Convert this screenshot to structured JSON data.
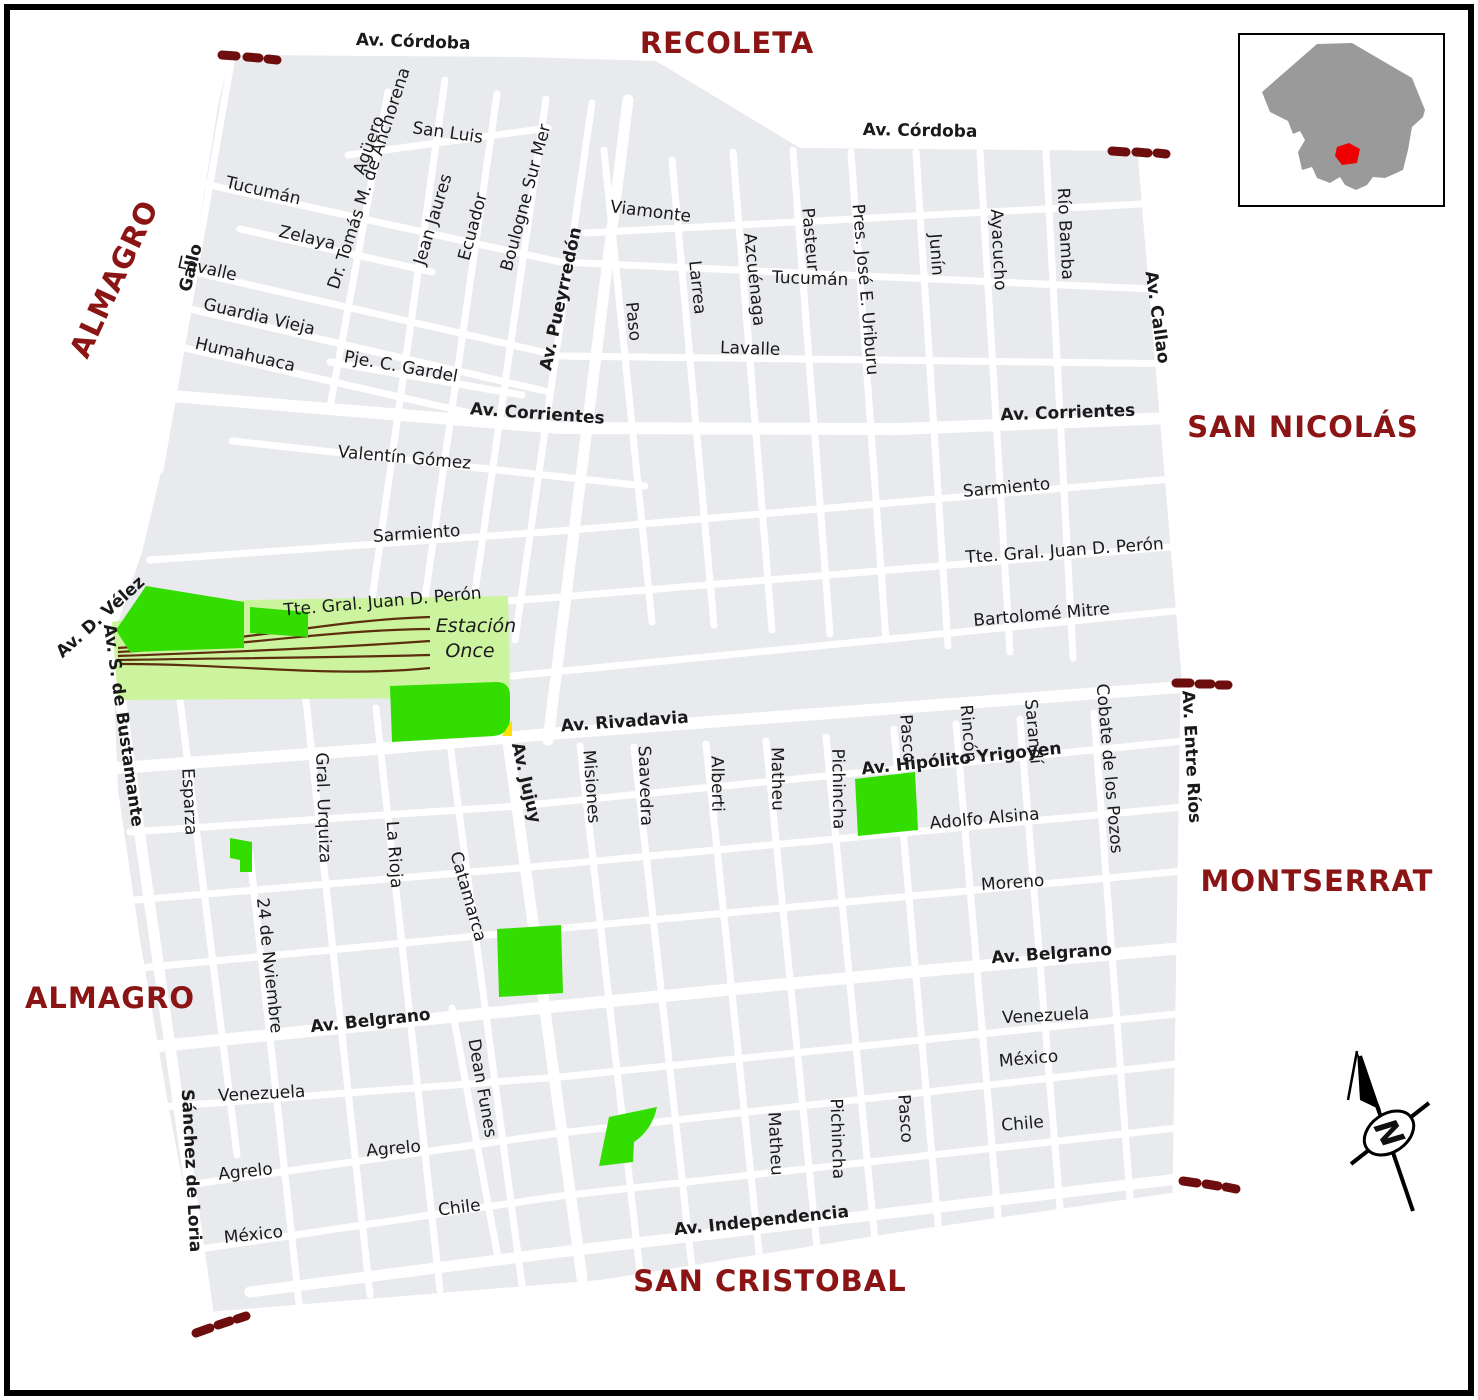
{
  "neighborhood_labels": [
    {
      "text": "RECOLETA",
      "x": 727,
      "y": 53,
      "rot": 0
    },
    {
      "text": "ALMAGRO",
      "x": 123,
      "y": 283,
      "rot": -65
    },
    {
      "text": "SAN NICOLÁS",
      "x": 1303,
      "y": 437,
      "rot": 0
    },
    {
      "text": "MONTSERRAT",
      "x": 1317,
      "y": 891,
      "rot": 0
    },
    {
      "text": "ALMAGRO",
      "x": 110,
      "y": 1008,
      "rot": 0
    },
    {
      "text": "SAN CRISTOBAL",
      "x": 770,
      "y": 1291,
      "rot": 0
    }
  ],
  "street_labels": [
    {
      "text": "Av. Córdoba",
      "x": 413,
      "y": 47,
      "rot": 2,
      "bold": true
    },
    {
      "text": "San Luis",
      "x": 447,
      "y": 138,
      "rot": 8
    },
    {
      "text": "Tucumán",
      "x": 262,
      "y": 196,
      "rot": 13
    },
    {
      "text": "Zelaya",
      "x": 306,
      "y": 243,
      "rot": 13
    },
    {
      "text": "Lavalle",
      "x": 206,
      "y": 274,
      "rot": 13
    },
    {
      "text": "Guardia Vieja",
      "x": 258,
      "y": 322,
      "rot": 13
    },
    {
      "text": "Humahuaca",
      "x": 244,
      "y": 360,
      "rot": 13
    },
    {
      "text": "Pje. C. Gardel",
      "x": 400,
      "y": 372,
      "rot": 10
    },
    {
      "text": "Av. Corrientes",
      "x": 537,
      "y": 419,
      "rot": 4,
      "bold": true
    },
    {
      "text": "Valentín Gómez",
      "x": 404,
      "y": 463,
      "rot": 5
    },
    {
      "text": "Sarmiento",
      "x": 417,
      "y": 539,
      "rot": -4
    },
    {
      "text": "Tte. Gral. Juan D. Perón",
      "x": 383,
      "y": 607,
      "rot": -5
    },
    {
      "text": "Av. Rivadavia",
      "x": 625,
      "y": 727,
      "rot": -4,
      "bold": true
    },
    {
      "text": "Viamonte",
      "x": 650,
      "y": 217,
      "rot": 7
    },
    {
      "text": "Av. Córdoba",
      "x": 920,
      "y": 136,
      "rot": 1,
      "bold": true
    },
    {
      "text": "Tucumán",
      "x": 810,
      "y": 284,
      "rot": 2
    },
    {
      "text": "Lavalle",
      "x": 750,
      "y": 354,
      "rot": 2
    },
    {
      "text": "Av. Corrientes",
      "x": 1068,
      "y": 418,
      "rot": -2,
      "bold": true
    },
    {
      "text": "Sarmiento",
      "x": 1007,
      "y": 493,
      "rot": -5
    },
    {
      "text": "Tte. Gral. Juan D. Perón",
      "x": 1065,
      "y": 556,
      "rot": -4
    },
    {
      "text": "Bartolomé Mitre",
      "x": 1042,
      "y": 620,
      "rot": -5
    },
    {
      "text": "Av. Hipólito Yrigoyen",
      "x": 962,
      "y": 764,
      "rot": -6,
      "bold": true
    },
    {
      "text": "Adolfo Alsina",
      "x": 985,
      "y": 824,
      "rot": -5
    },
    {
      "text": "Moreno",
      "x": 1013,
      "y": 888,
      "rot": -4
    },
    {
      "text": "Av. Belgrano",
      "x": 1052,
      "y": 959,
      "rot": -4,
      "bold": true
    },
    {
      "text": "Venezuela",
      "x": 1046,
      "y": 1021,
      "rot": -3
    },
    {
      "text": "México",
      "x": 1029,
      "y": 1064,
      "rot": -5
    },
    {
      "text": "Chile",
      "x": 1023,
      "y": 1129,
      "rot": -5
    },
    {
      "text": "Av. Belgrano",
      "x": 371,
      "y": 1026,
      "rot": -6,
      "bold": true
    },
    {
      "text": "Venezuela",
      "x": 262,
      "y": 1099,
      "rot": -3
    },
    {
      "text": "Agrelo",
      "x": 394,
      "y": 1154,
      "rot": -5
    },
    {
      "text": "Agrelo",
      "x": 246,
      "y": 1177,
      "rot": -6
    },
    {
      "text": "México",
      "x": 254,
      "y": 1240,
      "rot": -6
    },
    {
      "text": "Chile",
      "x": 460,
      "y": 1213,
      "rot": -7
    },
    {
      "text": "Av. Independencia",
      "x": 762,
      "y": 1226,
      "rot": -6,
      "bold": true
    },
    {
      "text": "Gallo",
      "x": 196,
      "y": 269,
      "rot": -76,
      "bold": true
    },
    {
      "text": "Agüero",
      "x": 374,
      "y": 147,
      "rot": -70
    },
    {
      "text": "Dr. Tomás M. de Anchorena",
      "x": 374,
      "y": 180,
      "rot": -72
    },
    {
      "text": "Jean Jaures",
      "x": 438,
      "y": 221,
      "rot": -73
    },
    {
      "text": "Ecuador",
      "x": 478,
      "y": 228,
      "rot": -75
    },
    {
      "text": "Boulogne Sur Mer",
      "x": 531,
      "y": 199,
      "rot": -75
    },
    {
      "text": "Av. Pueyrredón",
      "x": 566,
      "y": 300,
      "rot": -78,
      "bold": true
    },
    {
      "text": "Paso",
      "x": 628,
      "y": 322,
      "rot": 84
    },
    {
      "text": "Larrea",
      "x": 692,
      "y": 288,
      "rot": 84
    },
    {
      "text": "Azcuénaga",
      "x": 749,
      "y": 280,
      "rot": 84
    },
    {
      "text": "Pasteur",
      "x": 805,
      "y": 240,
      "rot": 85
    },
    {
      "text": "Pres. José E. Uriburu",
      "x": 860,
      "y": 290,
      "rot": 85
    },
    {
      "text": "Junín",
      "x": 931,
      "y": 255,
      "rot": 86
    },
    {
      "text": "Ayacucho",
      "x": 993,
      "y": 250,
      "rot": 87
    },
    {
      "text": "Río Bamba",
      "x": 1060,
      "y": 234,
      "rot": 87
    },
    {
      "text": "Av. Callao",
      "x": 1152,
      "y": 318,
      "rot": 82,
      "bold": true
    },
    {
      "text": "Av. D. Vélez",
      "x": 104,
      "y": 621,
      "rot": -42,
      "bold": true
    },
    {
      "text": "Av. S. de Bustamante",
      "x": 118,
      "y": 726,
      "rot": 82,
      "bold": true
    },
    {
      "text": "Esparza",
      "x": 184,
      "y": 802,
      "rot": 87
    },
    {
      "text": "Gral. Urquiza",
      "x": 318,
      "y": 808,
      "rot": 88
    },
    {
      "text": "La Rioja",
      "x": 389,
      "y": 855,
      "rot": 86
    },
    {
      "text": "Catamarca",
      "x": 463,
      "y": 898,
      "rot": 74
    },
    {
      "text": "Av. Jujuy",
      "x": 521,
      "y": 784,
      "rot": 77,
      "bold": true
    },
    {
      "text": "Misiones",
      "x": 586,
      "y": 787,
      "rot": 86
    },
    {
      "text": "Saavedra",
      "x": 640,
      "y": 786,
      "rot": 88
    },
    {
      "text": "Alberti",
      "x": 712,
      "y": 784,
      "rot": 89
    },
    {
      "text": "Matheu",
      "x": 772,
      "y": 779,
      "rot": 89
    },
    {
      "text": "Pichincha",
      "x": 833,
      "y": 789,
      "rot": 89
    },
    {
      "text": "Pasco",
      "x": 902,
      "y": 739,
      "rot": 86
    },
    {
      "text": "Rincón",
      "x": 963,
      "y": 734,
      "rot": 85
    },
    {
      "text": "Sarandí",
      "x": 1028,
      "y": 732,
      "rot": 85
    },
    {
      "text": "Cobate de los Pozos",
      "x": 1104,
      "y": 769,
      "rot": 85
    },
    {
      "text": "Av. Entre Ríos",
      "x": 1186,
      "y": 757,
      "rot": 87,
      "bold": true
    },
    {
      "text": "24 de Nviembre",
      "x": 264,
      "y": 966,
      "rot": 84
    },
    {
      "text": "Sánchez de Loria",
      "x": 186,
      "y": 1171,
      "rot": 87,
      "bold": true
    },
    {
      "text": "Dean Funes",
      "x": 477,
      "y": 1089,
      "rot": 80
    },
    {
      "text": "Matheu",
      "x": 770,
      "y": 1144,
      "rot": 87
    },
    {
      "text": "Pichincha",
      "x": 832,
      "y": 1139,
      "rot": 88
    },
    {
      "text": "Pasco",
      "x": 900,
      "y": 1119,
      "rot": 86
    }
  ],
  "landmark_labels": [
    {
      "text": "Estación",
      "x": 476,
      "y": 632,
      "rot": 0
    },
    {
      "text": "Once",
      "x": 470,
      "y": 657,
      "rot": 0
    }
  ],
  "compass": {
    "letter": "N",
    "letter_color": "#ff0000"
  },
  "colors": {
    "block_fill": "#e8eaee",
    "street": "#ffffff",
    "park_green": "#33dd00",
    "railyard_green": "#ccf39e",
    "rail_line": "#5c2e0e",
    "neighborhood_text": "#8b1414",
    "street_text": "#1a1a1a",
    "boundary_dash": "#6e0d0d",
    "yellow_patch": "#ffe000",
    "inset_city_gray": "#9a9a9a",
    "inset_highlight_red": "#ee0000",
    "frame": "#000000"
  }
}
